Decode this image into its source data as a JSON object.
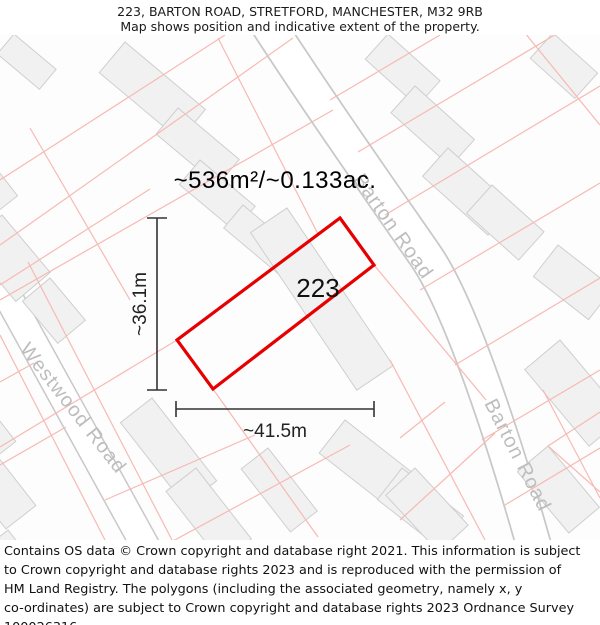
{
  "header": {
    "title": "223, BARTON ROAD, STRETFORD, MANCHESTER, M32 9RB",
    "subtitle": "Map shows position and indicative extent of the property."
  },
  "map": {
    "area_label": "~536m²/~0.133ac.",
    "plot_number": "223",
    "width_label": "~41.5m",
    "height_label": "~36.1m",
    "roads": {
      "barton_upper": "Barton Road",
      "barton_lower": "Barton Road",
      "westwood": "Westwood Road"
    },
    "colors": {
      "plot_outline": "#e60000",
      "parcel_line": "#f7b9b3",
      "building_fill": "#f1f1f1",
      "building_stroke": "#cfcfcf",
      "road_casing": "#c8c8c8",
      "road_fill": "#ffffff",
      "road_label_text": "#bdbdbd",
      "dimension_line": "#333333"
    }
  },
  "footer": {
    "lines": [
      "Contains OS data © Crown copyright and database right 2021. This information is subject",
      "to Crown copyright and database rights 2023 and is reproduced with the permission of",
      "HM Land Registry. The polygons (including the associated geometry, namely x, y",
      "co-ordinates) are subject to Crown copyright and database rights 2023 Ordnance Survey",
      "100026316."
    ]
  }
}
